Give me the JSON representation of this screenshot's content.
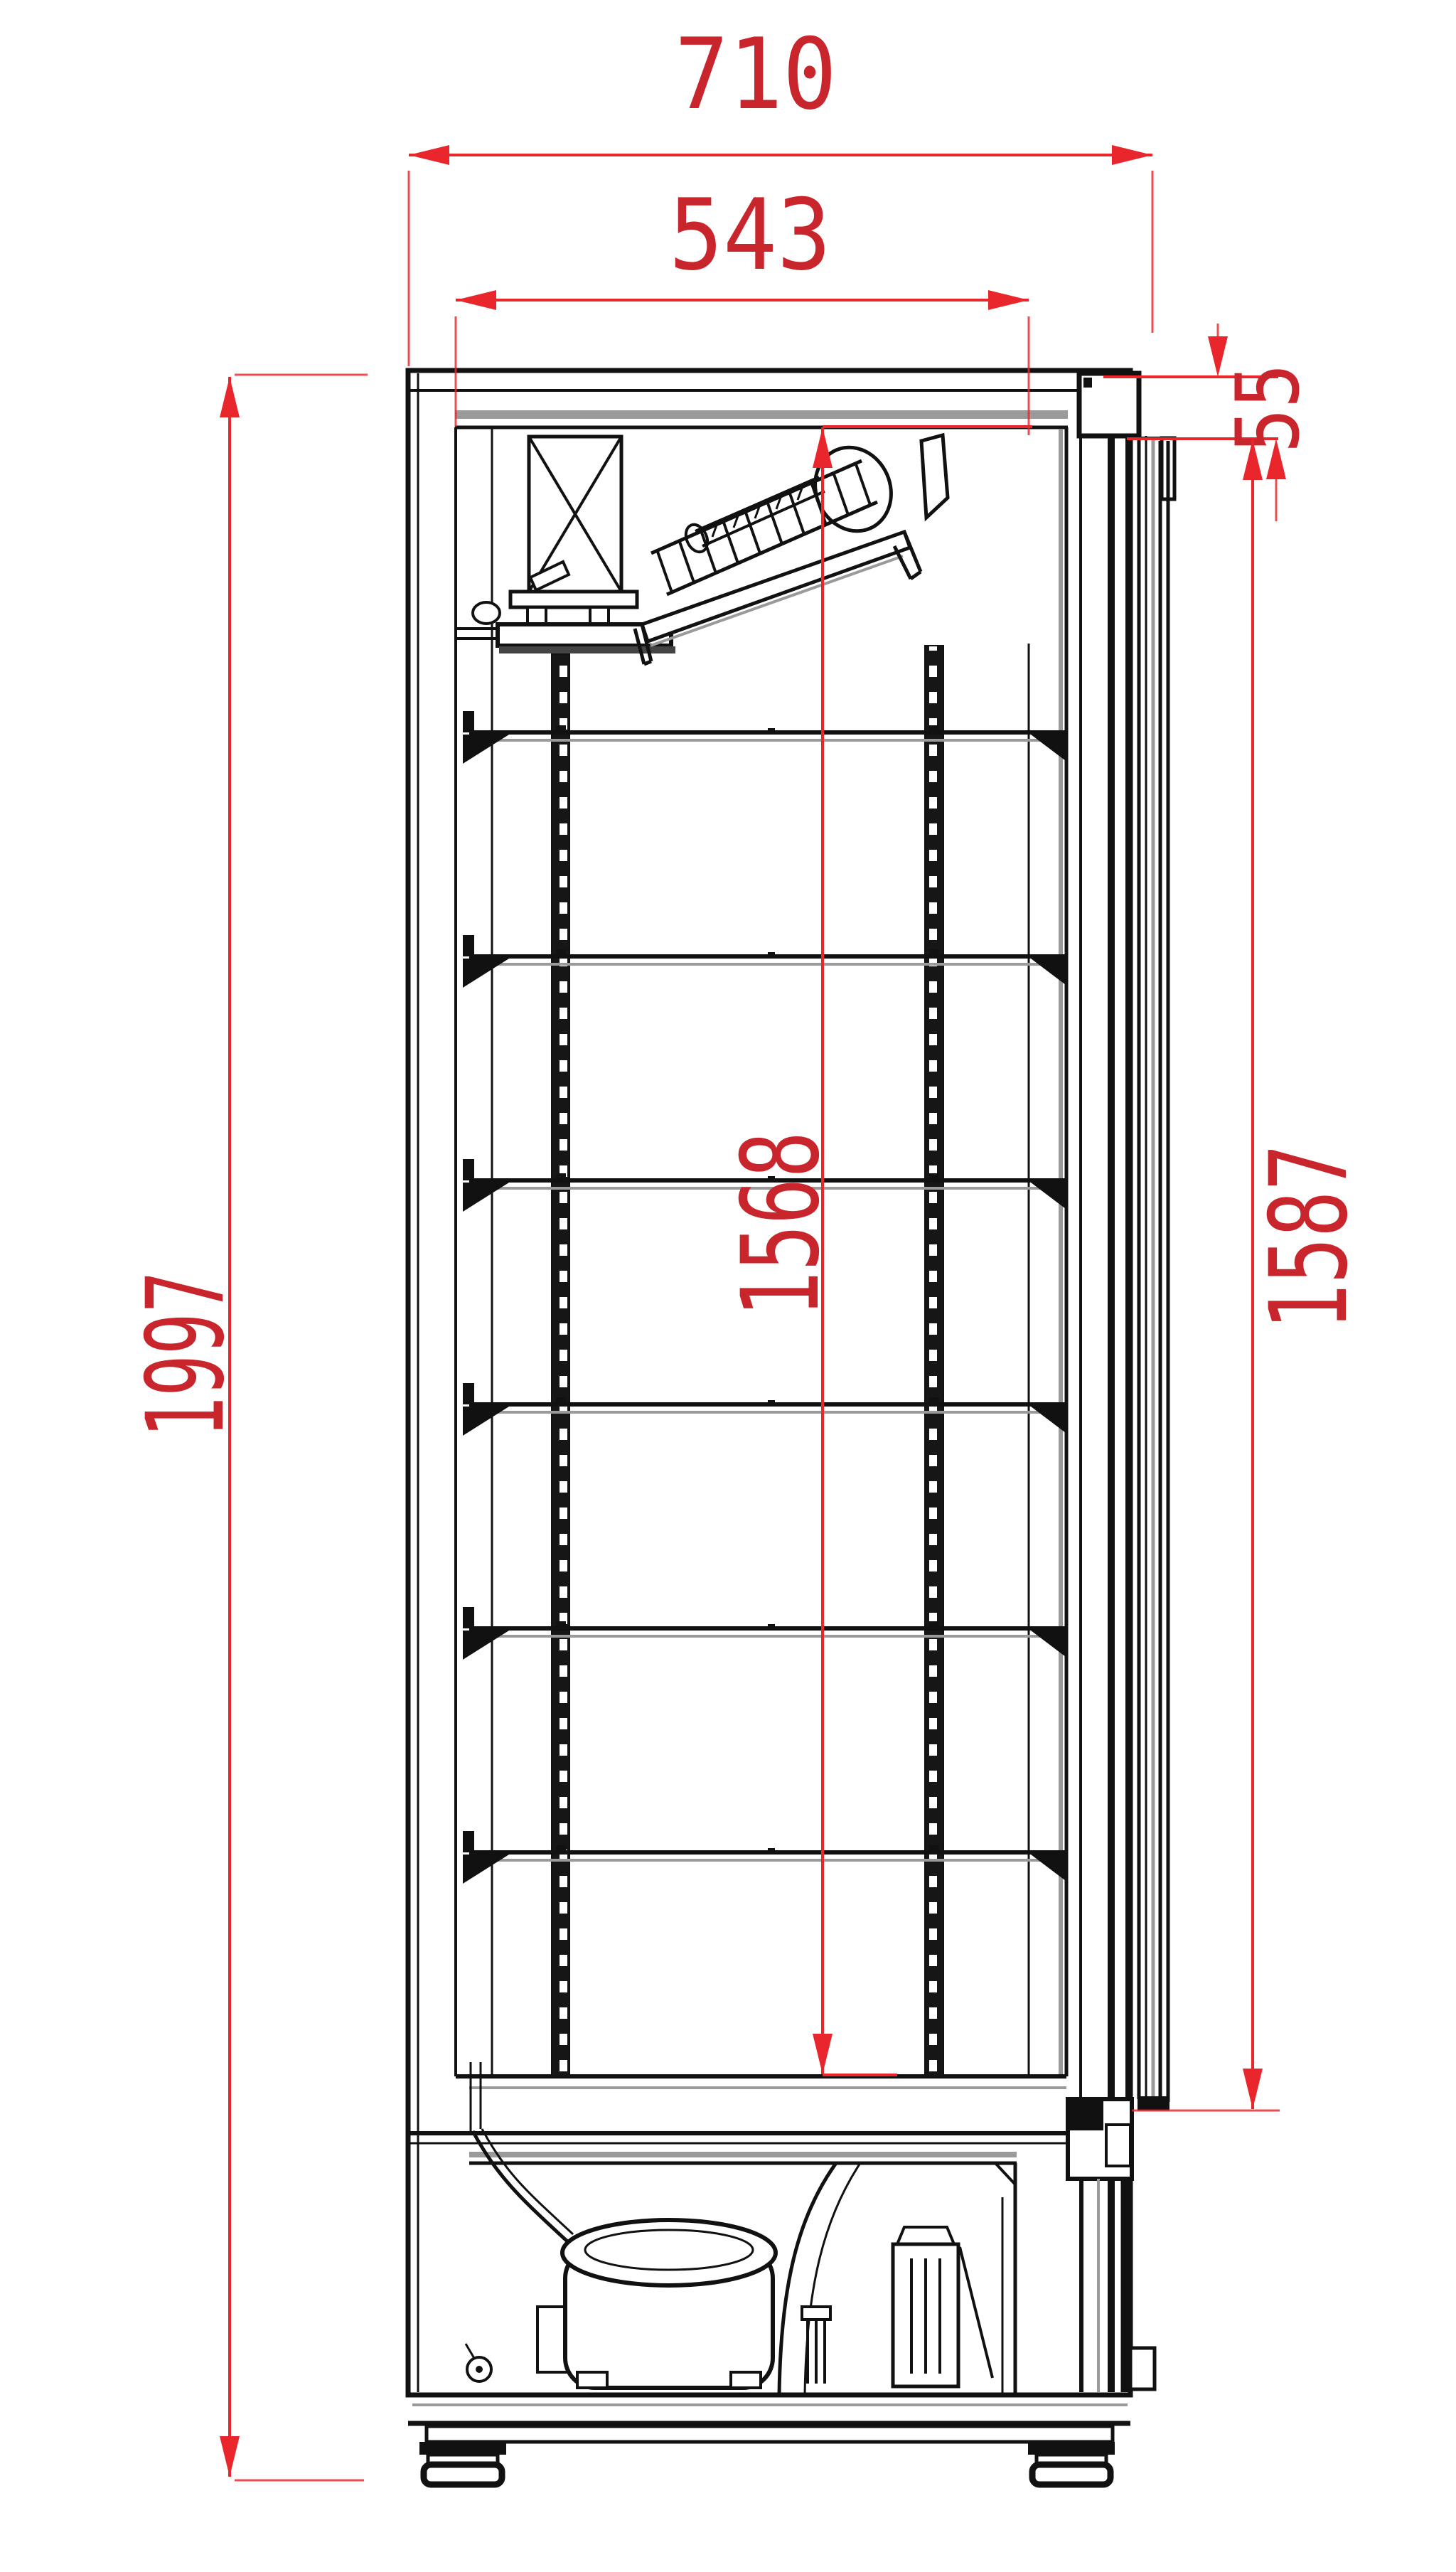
{
  "drawing": {
    "kind": "refrigerated-cabinet-side-section",
    "units": "mm",
    "colors": {
      "dimension_lines": "#e8262b",
      "dimension_text": "#c9252c",
      "linework": "#111111",
      "shadow": "#9a9a9a",
      "background": "#ffffff"
    },
    "dimensions": {
      "outer_width": "710",
      "inner_width": "543",
      "top_offset": "55",
      "interior_height": "1568",
      "door_height": "1587",
      "overall_height": "1997"
    }
  }
}
